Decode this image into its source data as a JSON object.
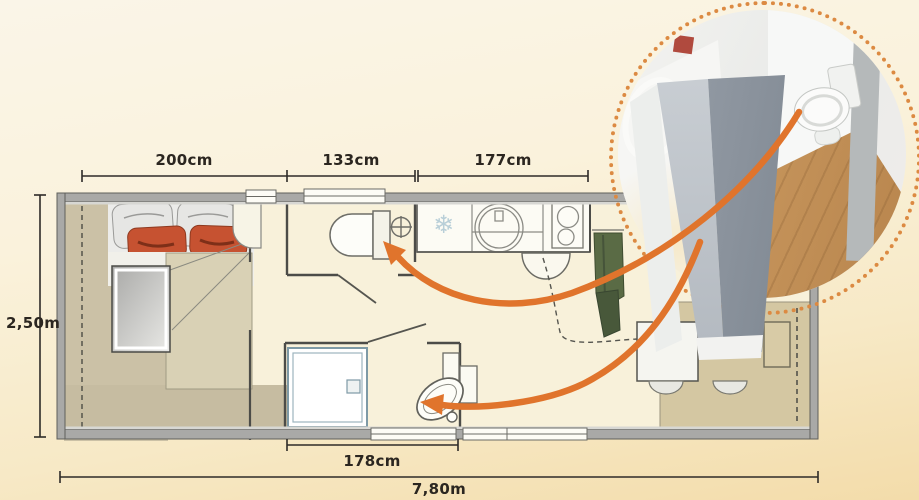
{
  "dimensions": {
    "top_bedroom": "200cm",
    "top_wc": "133cm",
    "top_kitchen": "177cm",
    "left_width": "2,50m",
    "bottom_shower": "178cm",
    "bottom_total": "7,80m"
  },
  "icons": {
    "fridge_symbol": "❄"
  },
  "colors": {
    "background_top": "#faf4e4",
    "background_bottom": "#f3dcaa",
    "wall": "#a9a9a7",
    "accent_arrow": "#e0742c",
    "inset_ring_dots": "#dc8a42",
    "bed_cushion": "#c65231",
    "curtain_green": "#5a6b45",
    "wood_floor": "#cf9e63",
    "shower_outline": "#7e9aa6"
  }
}
